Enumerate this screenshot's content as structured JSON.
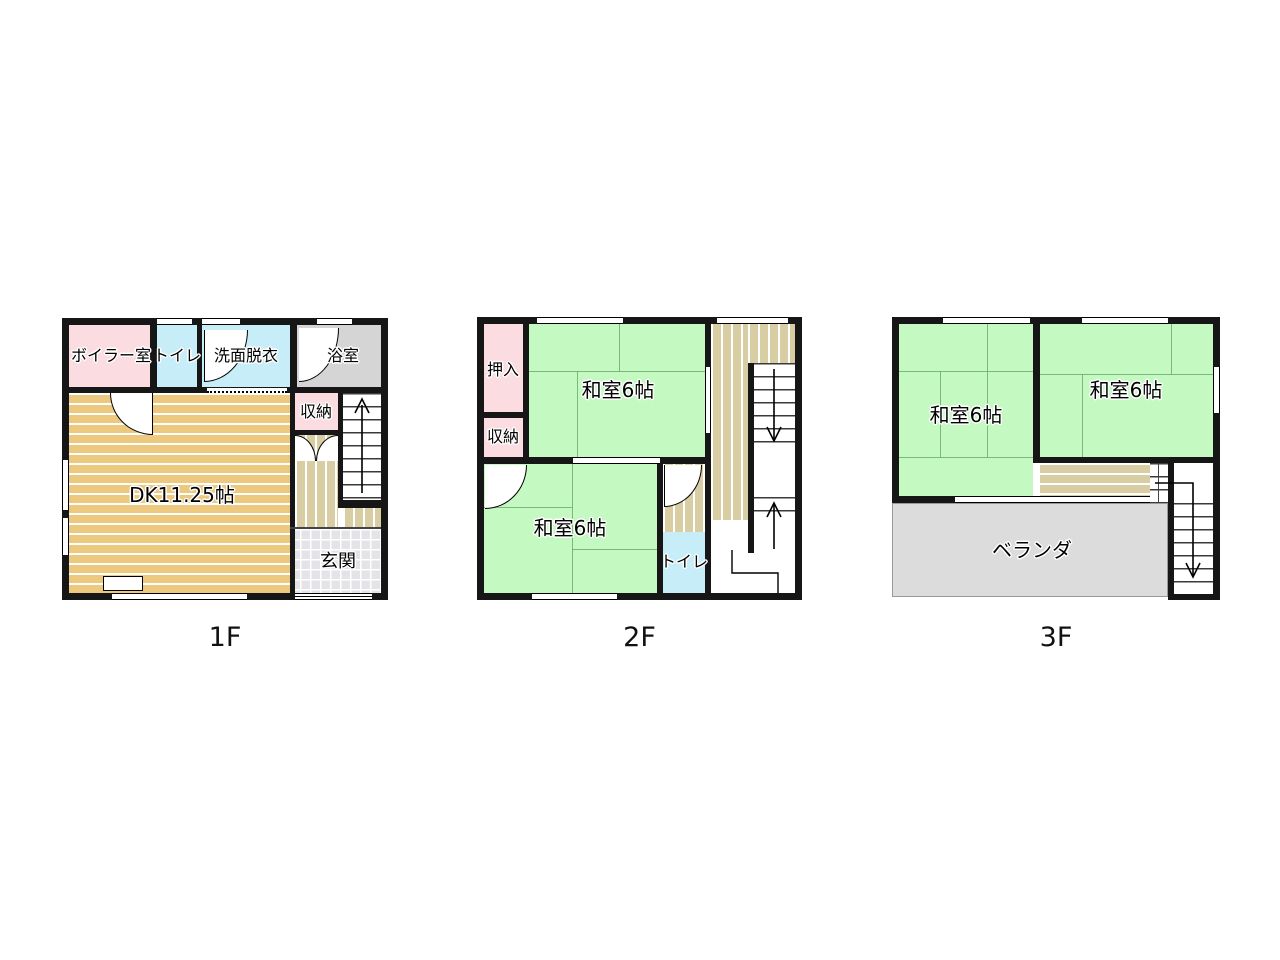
{
  "floors": [
    {
      "name": "1F",
      "rooms": {
        "boiler": "ボイラー室",
        "toilet": "トイレ",
        "washroom": "洗面脱衣",
        "bath": "浴室",
        "storage": "収納",
        "dk": "DK11.25帖",
        "genkan": "玄関"
      }
    },
    {
      "name": "2F",
      "rooms": {
        "oshiire": "押入",
        "storage": "収納",
        "washitsu_top": "和室6帖",
        "washitsu_bottom": "和室6帖",
        "toilet": "トイレ"
      }
    },
    {
      "name": "3F",
      "rooms": {
        "washitsu_left": "和室6帖",
        "washitsu_right": "和室6帖",
        "veranda": "ベランダ"
      }
    }
  ],
  "colors": {
    "wall": "#161616",
    "pink": "#fbdce1",
    "cyan": "#c7edf8",
    "bath_gray": "#d5d5d5",
    "dk_tan": "#ecc97e",
    "tatami_green": "#c5f9c2",
    "tatami_line": "#69a869",
    "hall_beige": "#d9cda4",
    "genkan_gray": "#e3e3e8",
    "veranda_gray": "#dcdcdc"
  }
}
